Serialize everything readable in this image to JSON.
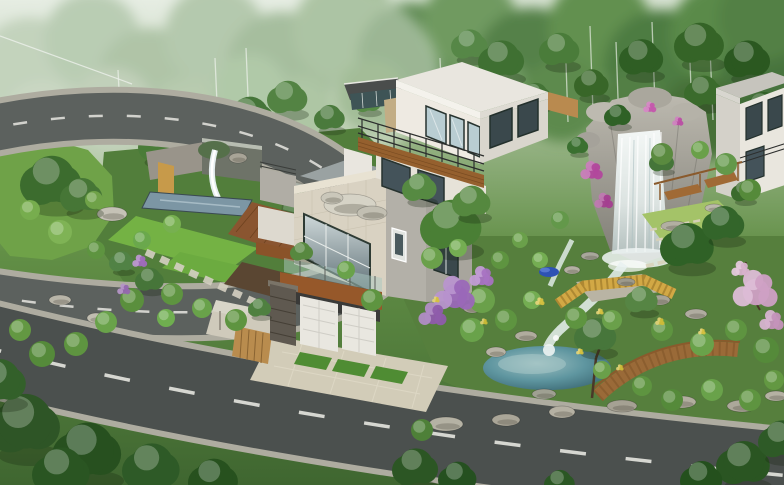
{
  "meta": {
    "type": "3d-architectural-rendering",
    "description": "Aerial rendering of a modern hillside villa: two white cubic volumes with wood accents and glass balconies, a curved asphalt road with dashed lane markings, landscaped gardens, a rock waterfall, a teal pond, lawns, purple and pink flowering trees, and dense misty forest behind."
  },
  "palette": {
    "skyTop": "#d7e2d2",
    "skyMid": "#9cb78c",
    "grass": "#628f46",
    "grassDark": "#3f6630",
    "roadUpper": "#5c615e",
    "roadLower": "#4b504e",
    "curb": "#aeaca0",
    "dash": "#e6e6e0",
    "islandGrass": "#6fa248",
    "gardenGround": "#527e3b",
    "lawnBright": "#74b244",
    "lawnYellow": "#a4c368",
    "bank": "#57923c",
    "poolBlue": "#7c96a4",
    "waterWhite": "#eef4f3",
    "rockLight": "#b3b1a8",
    "rockDark": "#7e7c74",
    "woodDeck": "#8a5530",
    "woodBeam": "#96582a",
    "woodBridge": "#9a6a38",
    "fenceYellow": "#d2a845",
    "wallWhite": "#eeeae2",
    "wallShade": "#d9d6cd",
    "wallBeige": "#d9d2c2",
    "wallGray": "#b3b0a8",
    "glassDark": "#3a484c",
    "glassLight": "#b9cdd2",
    "frame": "#27332f",
    "stoneDark": "#5f5950",
    "tarpBlue": "#2e52b4",
    "canopyPale": "#d8d5c8",
    "trellisTan": "#b98c4e",
    "driveway": "#d2ccb8",
    "plaza": "#cfcabb",
    "terraceFloor": "#9aa2a2"
  },
  "scene": {
    "forest": [
      [
        30,
        70,
        52,
        "#9fb894"
      ],
      [
        92,
        40,
        48,
        "#8fae85"
      ],
      [
        150,
        80,
        52,
        "#7fa172"
      ],
      [
        215,
        35,
        50,
        "#87a87b"
      ],
      [
        282,
        68,
        56,
        "#6f9663"
      ],
      [
        345,
        30,
        52,
        "#7aa06c"
      ],
      [
        412,
        58,
        55,
        "#5f8a52"
      ],
      [
        470,
        24,
        48,
        "#6f9a60"
      ],
      [
        532,
        64,
        56,
        "#558148"
      ],
      [
        600,
        28,
        52,
        "#62904f"
      ],
      [
        662,
        68,
        58,
        "#4e7c42"
      ],
      [
        722,
        34,
        52,
        "#5a8a48"
      ],
      [
        772,
        78,
        52,
        "#47733c"
      ],
      [
        762,
        18,
        44,
        "#538044"
      ],
      [
        42,
        120,
        38,
        "#aabf9f"
      ],
      [
        112,
        110,
        42,
        "#9cb490"
      ],
      [
        188,
        118,
        40,
        "#8cab7e"
      ],
      [
        492,
        92,
        38,
        "#6f9a62"
      ],
      [
        562,
        100,
        42,
        "#5d8a4e"
      ],
      [
        632,
        108,
        38,
        "#527f44"
      ],
      [
        702,
        118,
        42,
        "#466f39"
      ],
      [
        760,
        130,
        36,
        "#416b35"
      ],
      [
        372,
        96,
        36,
        "#6a9459"
      ],
      [
        300,
        110,
        34,
        "#7ba36c"
      ],
      [
        250,
        90,
        36,
        "#80a873"
      ]
    ],
    "birches": [
      [
        565,
        34,
        122
      ],
      [
        590,
        26,
        112
      ],
      [
        616,
        42,
        126
      ],
      [
        652,
        22,
        106
      ],
      [
        689,
        34,
        116
      ],
      [
        710,
        48,
        120
      ],
      [
        215,
        58,
        126
      ],
      [
        246,
        48,
        120
      ],
      [
        440,
        58,
        128
      ],
      [
        118,
        70,
        130
      ]
    ],
    "trees_back": [
      [
        160,
        145,
        22,
        "#4a7c38"
      ],
      [
        196,
        124,
        18,
        "#568644"
      ],
      [
        250,
        118,
        26,
        "#457539"
      ],
      [
        288,
        98,
        21,
        "#538343"
      ],
      [
        232,
        156,
        17,
        "#3e6e33"
      ],
      [
        330,
        118,
        16,
        "#4a7a3c"
      ],
      [
        368,
        102,
        14,
        "#568a45"
      ],
      [
        470,
        45,
        19,
        "#568747"
      ],
      [
        502,
        60,
        24,
        "#3f7032"
      ],
      [
        560,
        50,
        21,
        "#4a7c3a"
      ],
      [
        592,
        84,
        18,
        "#386628"
      ],
      [
        642,
        58,
        23,
        "#2f5e24"
      ],
      [
        700,
        44,
        26,
        "#356427"
      ],
      [
        748,
        60,
        24,
        "#2b5820"
      ],
      [
        764,
        110,
        22,
        "#316126"
      ],
      [
        704,
        92,
        20,
        "#3b6b2c"
      ],
      [
        536,
        96,
        16,
        "#447436"
      ]
    ],
    "trees_mid": [
      [
        52,
        182,
        32,
        "#3c6c2e"
      ],
      [
        82,
        196,
        22,
        "#467636"
      ],
      [
        452,
        226,
        32,
        "#4a7f35"
      ],
      [
        472,
        202,
        20,
        "#55883f"
      ],
      [
        420,
        188,
        18,
        "#568a42"
      ],
      [
        618,
        116,
        14,
        "#2f6126"
      ],
      [
        578,
        146,
        11,
        "#3a7030"
      ],
      [
        688,
        246,
        28,
        "#2f6126"
      ],
      [
        724,
        224,
        22,
        "#33652a"
      ],
      [
        662,
        162,
        13,
        "#457539"
      ],
      [
        744,
        192,
        13,
        "#3b6b2c"
      ],
      [
        596,
        336,
        22,
        "#47763b"
      ],
      [
        642,
        300,
        17,
        "#568544"
      ],
      [
        260,
        308,
        12,
        "#4f8040"
      ],
      [
        150,
        280,
        15,
        "#467539"
      ],
      [
        122,
        262,
        13,
        "#518245"
      ],
      [
        302,
        252,
        12,
        "#57883f"
      ]
    ],
    "trees_fore": [
      [
        25,
        425,
        38,
        "#2e5526"
      ],
      [
        88,
        452,
        36,
        "#27501f"
      ],
      [
        152,
        468,
        30,
        "#2e5a27"
      ],
      [
        214,
        480,
        26,
        "#27511e"
      ],
      [
        0,
        382,
        28,
        "#33602a"
      ],
      [
        62,
        472,
        30,
        "#2a5522"
      ],
      [
        416,
        468,
        24,
        "#2c5624"
      ],
      [
        458,
        478,
        20,
        "#255020"
      ],
      [
        560,
        483,
        16,
        "#2b5724"
      ],
      [
        744,
        464,
        28,
        "#2a5522"
      ],
      [
        702,
        479,
        22,
        "#24501d"
      ],
      [
        782,
        440,
        24,
        "#2e5a27"
      ]
    ],
    "bushes": [
      [
        172,
        294,
        11,
        "#5e9440"
      ],
      [
        202,
        308,
        10,
        "#69a24a"
      ],
      [
        236,
        320,
        11,
        "#5e9440"
      ],
      [
        166,
        318,
        9,
        "#6fae4f"
      ],
      [
        132,
        300,
        12,
        "#5a8f3d"
      ],
      [
        106,
        322,
        11,
        "#69a24a"
      ],
      [
        76,
        344,
        12,
        "#5e9440"
      ],
      [
        42,
        354,
        13,
        "#558a3a"
      ],
      [
        20,
        330,
        11,
        "#639842"
      ],
      [
        482,
        300,
        13,
        "#6aa04a"
      ],
      [
        506,
        320,
        11,
        "#5e9440"
      ],
      [
        472,
        330,
        12,
        "#69a24a"
      ],
      [
        532,
        300,
        9,
        "#74ad52"
      ],
      [
        576,
        318,
        11,
        "#5e9440"
      ],
      [
        612,
        320,
        10,
        "#6aa04a"
      ],
      [
        662,
        330,
        11,
        "#5e9440"
      ],
      [
        702,
        344,
        12,
        "#69a24a"
      ],
      [
        736,
        330,
        11,
        "#5e9440"
      ],
      [
        766,
        350,
        13,
        "#558a3a"
      ],
      [
        602,
        370,
        9,
        "#6aa04a"
      ],
      [
        642,
        386,
        10,
        "#5e9440"
      ],
      [
        672,
        400,
        11,
        "#558a3a"
      ],
      [
        712,
        390,
        11,
        "#69a24a"
      ],
      [
        750,
        400,
        11,
        "#5e9440"
      ],
      [
        774,
        380,
        10,
        "#639842"
      ],
      [
        422,
        430,
        11,
        "#4e8038"
      ],
      [
        372,
        300,
        11,
        "#5e9440"
      ],
      [
        346,
        270,
        9,
        "#69a24a"
      ],
      [
        432,
        258,
        11,
        "#6aa04a"
      ],
      [
        458,
        248,
        9,
        "#74ad52"
      ],
      [
        662,
        154,
        11,
        "#5a8a3f"
      ],
      [
        726,
        164,
        11,
        "#63984a"
      ],
      [
        750,
        190,
        11,
        "#558a3a"
      ],
      [
        700,
        150,
        9,
        "#6aa04a"
      ],
      [
        172,
        224,
        9,
        "#77b050"
      ],
      [
        142,
        240,
        9,
        "#6aa84c"
      ],
      [
        96,
        250,
        9,
        "#5e9440"
      ],
      [
        560,
        220,
        9,
        "#63984a"
      ],
      [
        520,
        240,
        8,
        "#6aa04a"
      ],
      [
        500,
        260,
        9,
        "#5e9440"
      ],
      [
        540,
        260,
        8,
        "#74ad52"
      ],
      [
        60,
        232,
        12,
        "#7fb355"
      ],
      [
        30,
        210,
        10,
        "#77ad4e"
      ],
      [
        94,
        200,
        9,
        "#6fa248"
      ]
    ],
    "rocks": [
      [
        350,
        205,
        26,
        11,
        "#d6d3c6"
      ],
      [
        372,
        213,
        15,
        7,
        "#c2bfb2"
      ],
      [
        332,
        198,
        11,
        6,
        "#cac7ba"
      ],
      [
        112,
        214,
        15,
        7,
        "#c5c2b6"
      ],
      [
        96,
        318,
        9,
        5,
        "#c0bdb0"
      ],
      [
        60,
        300,
        11,
        5,
        "#b8b5a8"
      ],
      [
        446,
        424,
        17,
        7,
        "#b5b2a4"
      ],
      [
        506,
        420,
        14,
        6,
        "#aaa698"
      ],
      [
        562,
        412,
        13,
        6,
        "#b5b1a3"
      ],
      [
        622,
        406,
        15,
        6,
        "#a5a193"
      ],
      [
        682,
        402,
        14,
        6,
        "#b2ae9f"
      ],
      [
        742,
        406,
        15,
        6,
        "#aca89a"
      ],
      [
        776,
        396,
        11,
        5,
        "#b5b1a3"
      ],
      [
        472,
        308,
        9,
        5,
        "#a8a496"
      ],
      [
        526,
        336,
        11,
        5,
        "#b0ac9e"
      ],
      [
        590,
        256,
        9,
        4,
        "#a8a79b"
      ],
      [
        572,
        270,
        8,
        4,
        "#b3b0a2"
      ],
      [
        626,
        282,
        9,
        4,
        "#9d9a8c"
      ],
      [
        660,
        300,
        10,
        5,
        "#a8a496"
      ],
      [
        696,
        314,
        11,
        5,
        "#b0aca0"
      ],
      [
        674,
        226,
        13,
        5,
        "#b2afa2"
      ],
      [
        714,
        208,
        9,
        4,
        "#bbb8ab"
      ],
      [
        238,
        158,
        9,
        5,
        "#a8a497"
      ],
      [
        496,
        352,
        10,
        5,
        "#b7b3a5"
      ],
      [
        544,
        394,
        12,
        5,
        "#9fa092"
      ]
    ],
    "flowers": [
      [
        592,
        172,
        12,
        "#b2479c"
      ],
      [
        604,
        202,
        10,
        "#a43f90"
      ],
      [
        650,
        108,
        7,
        "#c457ac"
      ],
      [
        678,
        122,
        6,
        "#ba4fa4"
      ],
      [
        455,
        296,
        22,
        "#9a68b8"
      ],
      [
        433,
        316,
        15,
        "#8f5cab"
      ],
      [
        482,
        278,
        13,
        "#a873c2"
      ],
      [
        140,
        262,
        8,
        "#9f6cba"
      ],
      [
        124,
        290,
        7,
        "#9468ae"
      ],
      [
        756,
        292,
        24,
        "#cfa0c4"
      ],
      [
        772,
        322,
        13,
        "#c494ba"
      ],
      [
        741,
        270,
        10,
        "#d8b2cc"
      ],
      [
        540,
        302,
        5,
        "#d4c040"
      ],
      [
        600,
        312,
        4,
        "#d4c040"
      ],
      [
        660,
        322,
        5,
        "#ccba38"
      ],
      [
        702,
        332,
        4,
        "#d4c040"
      ],
      [
        484,
        322,
        4,
        "#c9b836"
      ],
      [
        436,
        300,
        4,
        "#d4c040"
      ],
      [
        620,
        368,
        4,
        "#ccba38"
      ],
      [
        580,
        352,
        4,
        "#d4c040"
      ]
    ]
  }
}
